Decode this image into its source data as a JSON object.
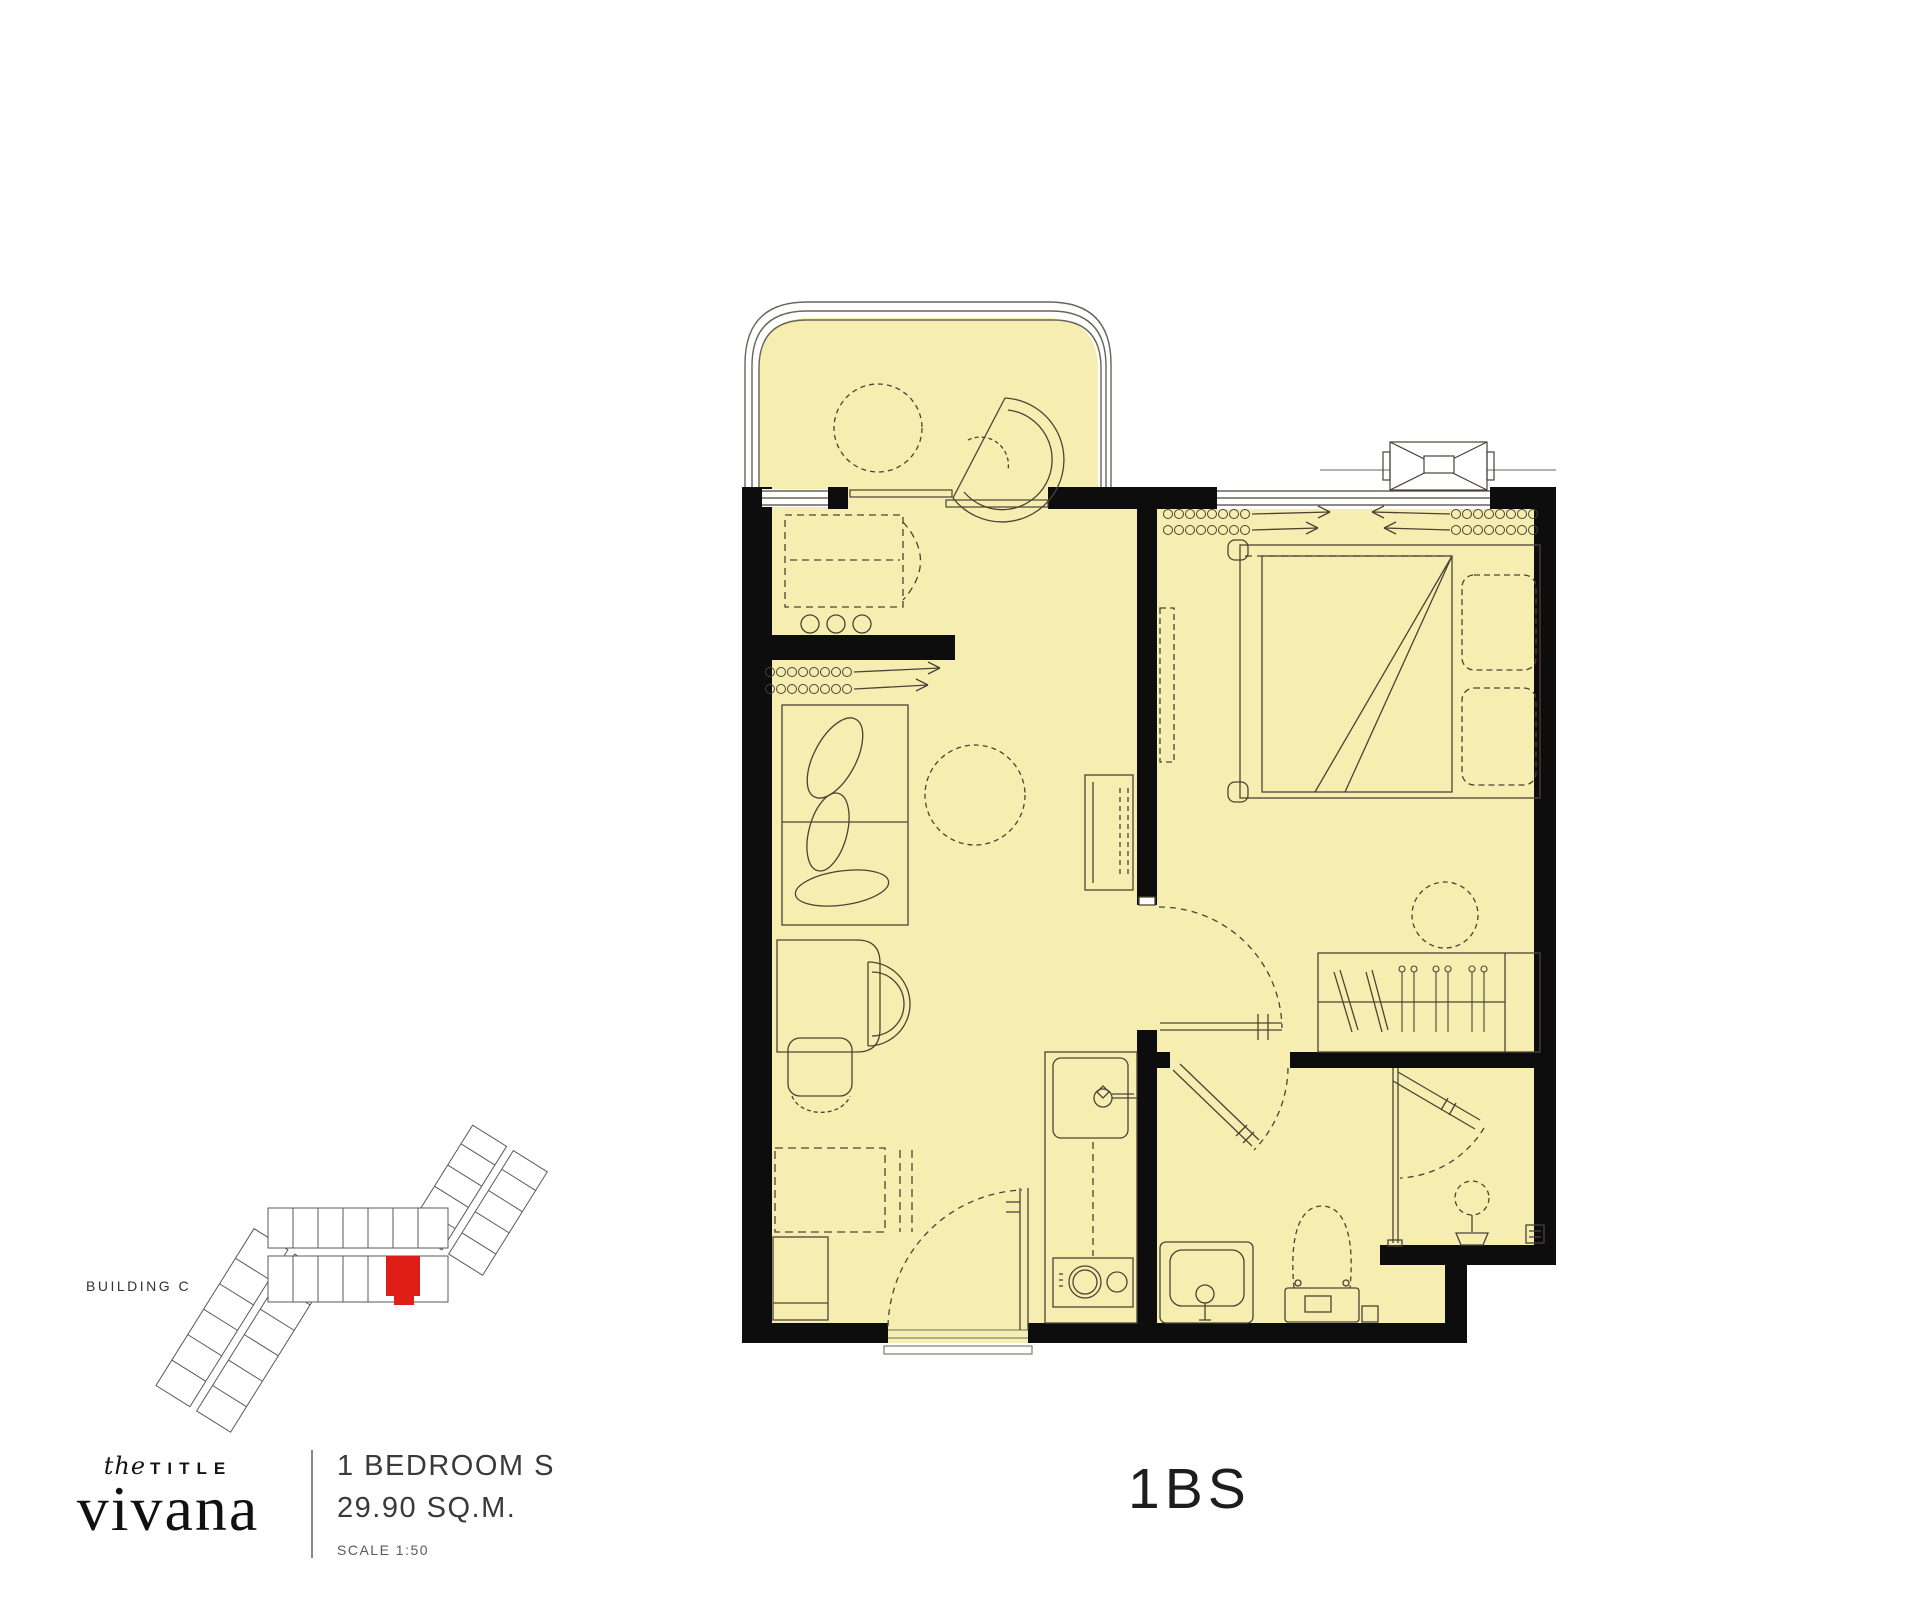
{
  "colors": {
    "floor_fill": "#f5eeb0",
    "wall": "#0d0d0d",
    "line": "#4a4336",
    "railing": "#6a655a",
    "highlight_unit": "#de1e17",
    "text": "#2f2f2f"
  },
  "site_plan": {
    "label": "BUILDING C"
  },
  "footer": {
    "brand": {
      "pre": "the",
      "title": "TITLE",
      "name": "vivana"
    },
    "unit_type": "1 BEDROOM S",
    "area": "29.90 SQ.M.",
    "scale": "SCALE 1:50",
    "unit_code": "1BS"
  }
}
